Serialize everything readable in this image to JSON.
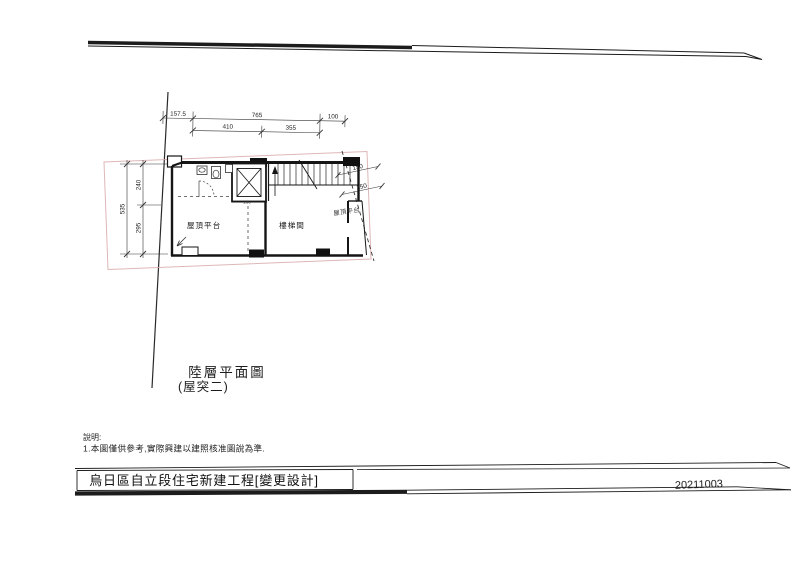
{
  "colors": {
    "paper": "#ffffff",
    "ink": "#1c1c1c",
    "lot_line": "#d8aaaa"
  },
  "plan": {
    "dims": {
      "d157": "157.5",
      "d765": "765",
      "d100": "100",
      "d410": "410",
      "d355": "355",
      "d535": "535",
      "d240": "240",
      "d295": "295",
      "d150a": "150",
      "d150b": "150",
      "d160": "160"
    },
    "labels": {
      "roof_platform": "屋頂平台",
      "stairwell": "樓梯間",
      "roof_platform_right": "屋頂平台"
    }
  },
  "title": {
    "main": "陸層平面圖",
    "sub": "(屋突二)"
  },
  "notes": {
    "heading": "說明:",
    "line1": "1.本圖僅供參考,實際興建以建照核准圖說為準."
  },
  "footer": {
    "project": "烏日區自立段住宅新建工程[變更設計]",
    "date": "20211003"
  }
}
